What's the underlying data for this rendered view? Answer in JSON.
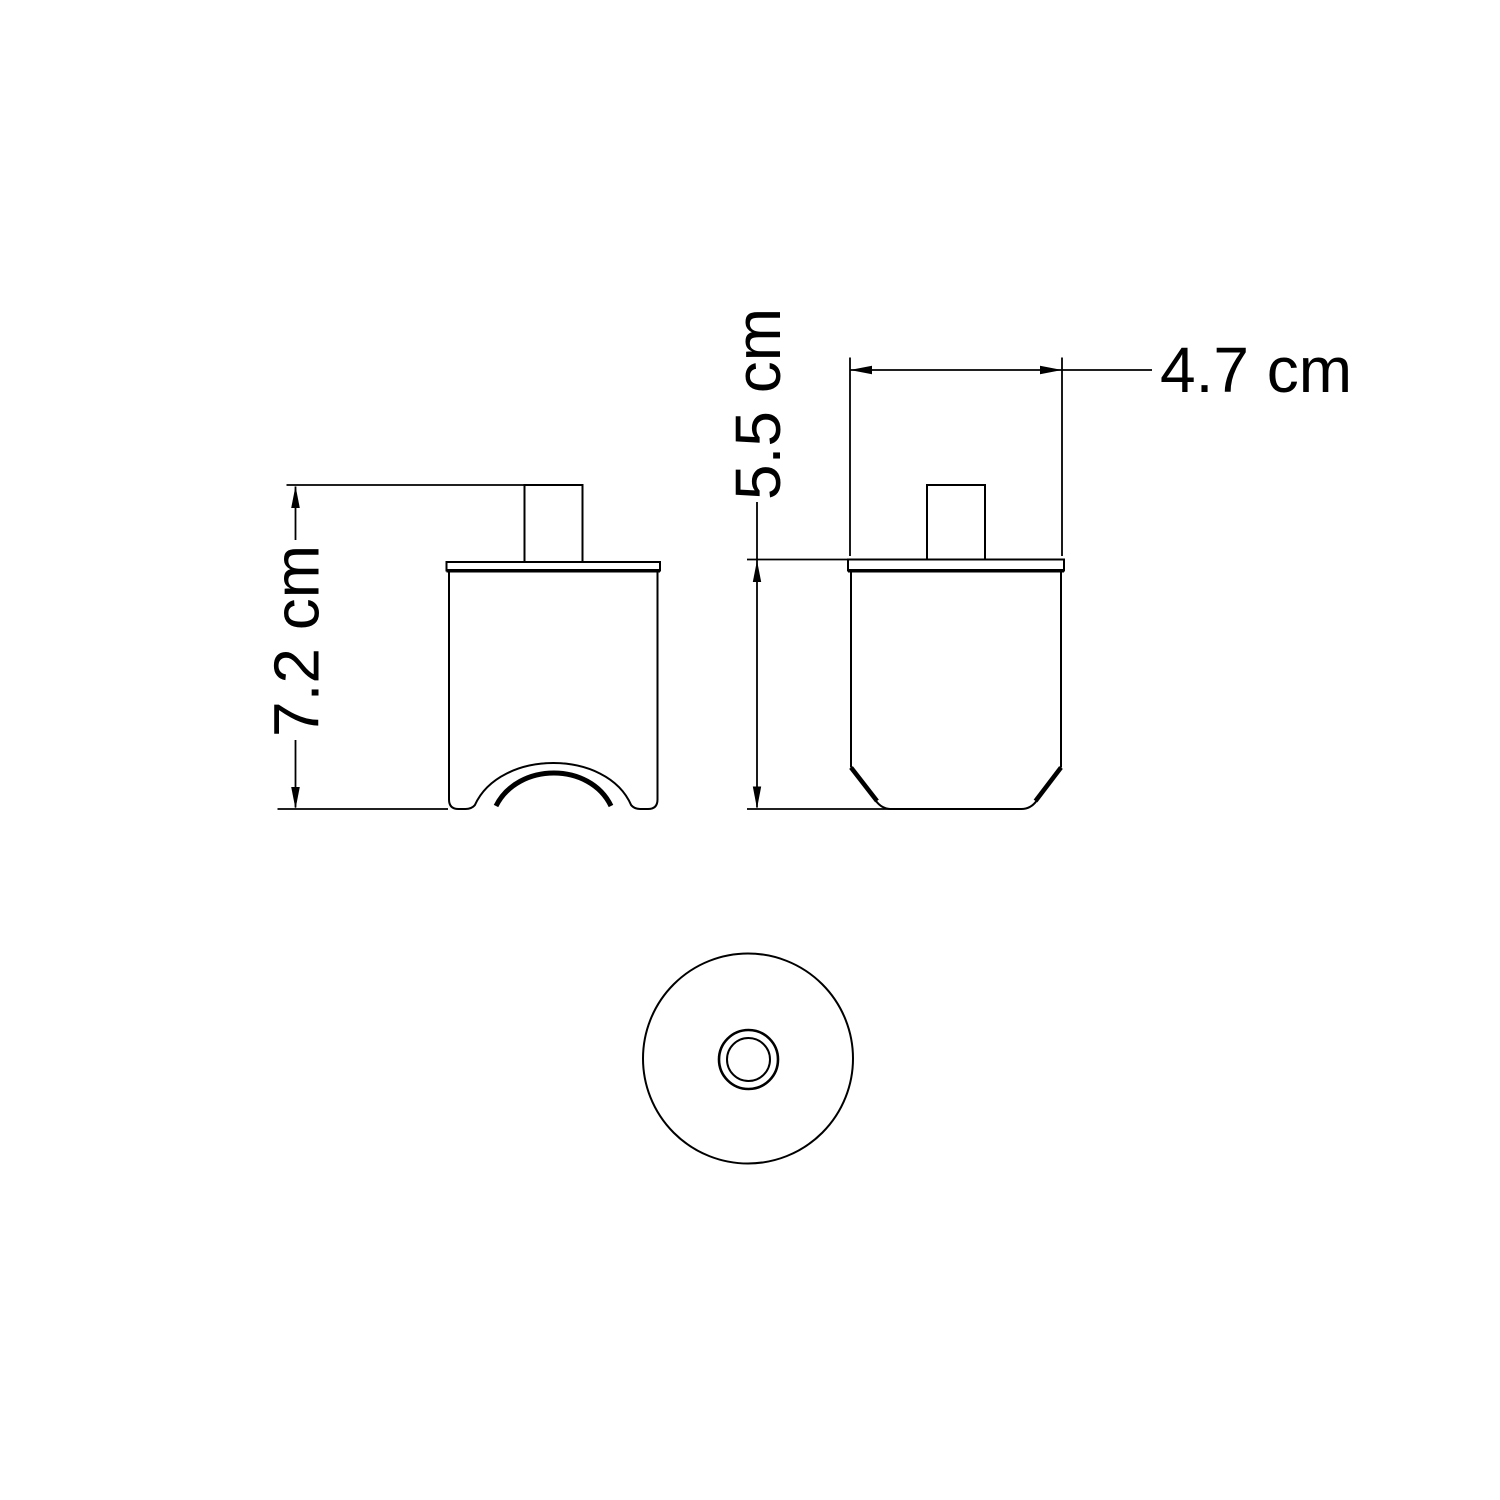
{
  "page": {
    "background": "#ffffff",
    "ink": "#000000"
  },
  "views": {
    "side": {
      "id": "side-view"
    },
    "front": {
      "id": "front-view"
    },
    "bottom": {
      "id": "bottom-view"
    }
  },
  "dimensions": {
    "overall_height": {
      "label": "7.2 cm",
      "value": "7.2",
      "unit": "cm"
    },
    "body_height": {
      "label": "5.5 cm",
      "value": "5.5",
      "unit": "cm"
    },
    "width": {
      "label": "4.7 cm",
      "value": "4.7",
      "unit": "cm"
    }
  }
}
